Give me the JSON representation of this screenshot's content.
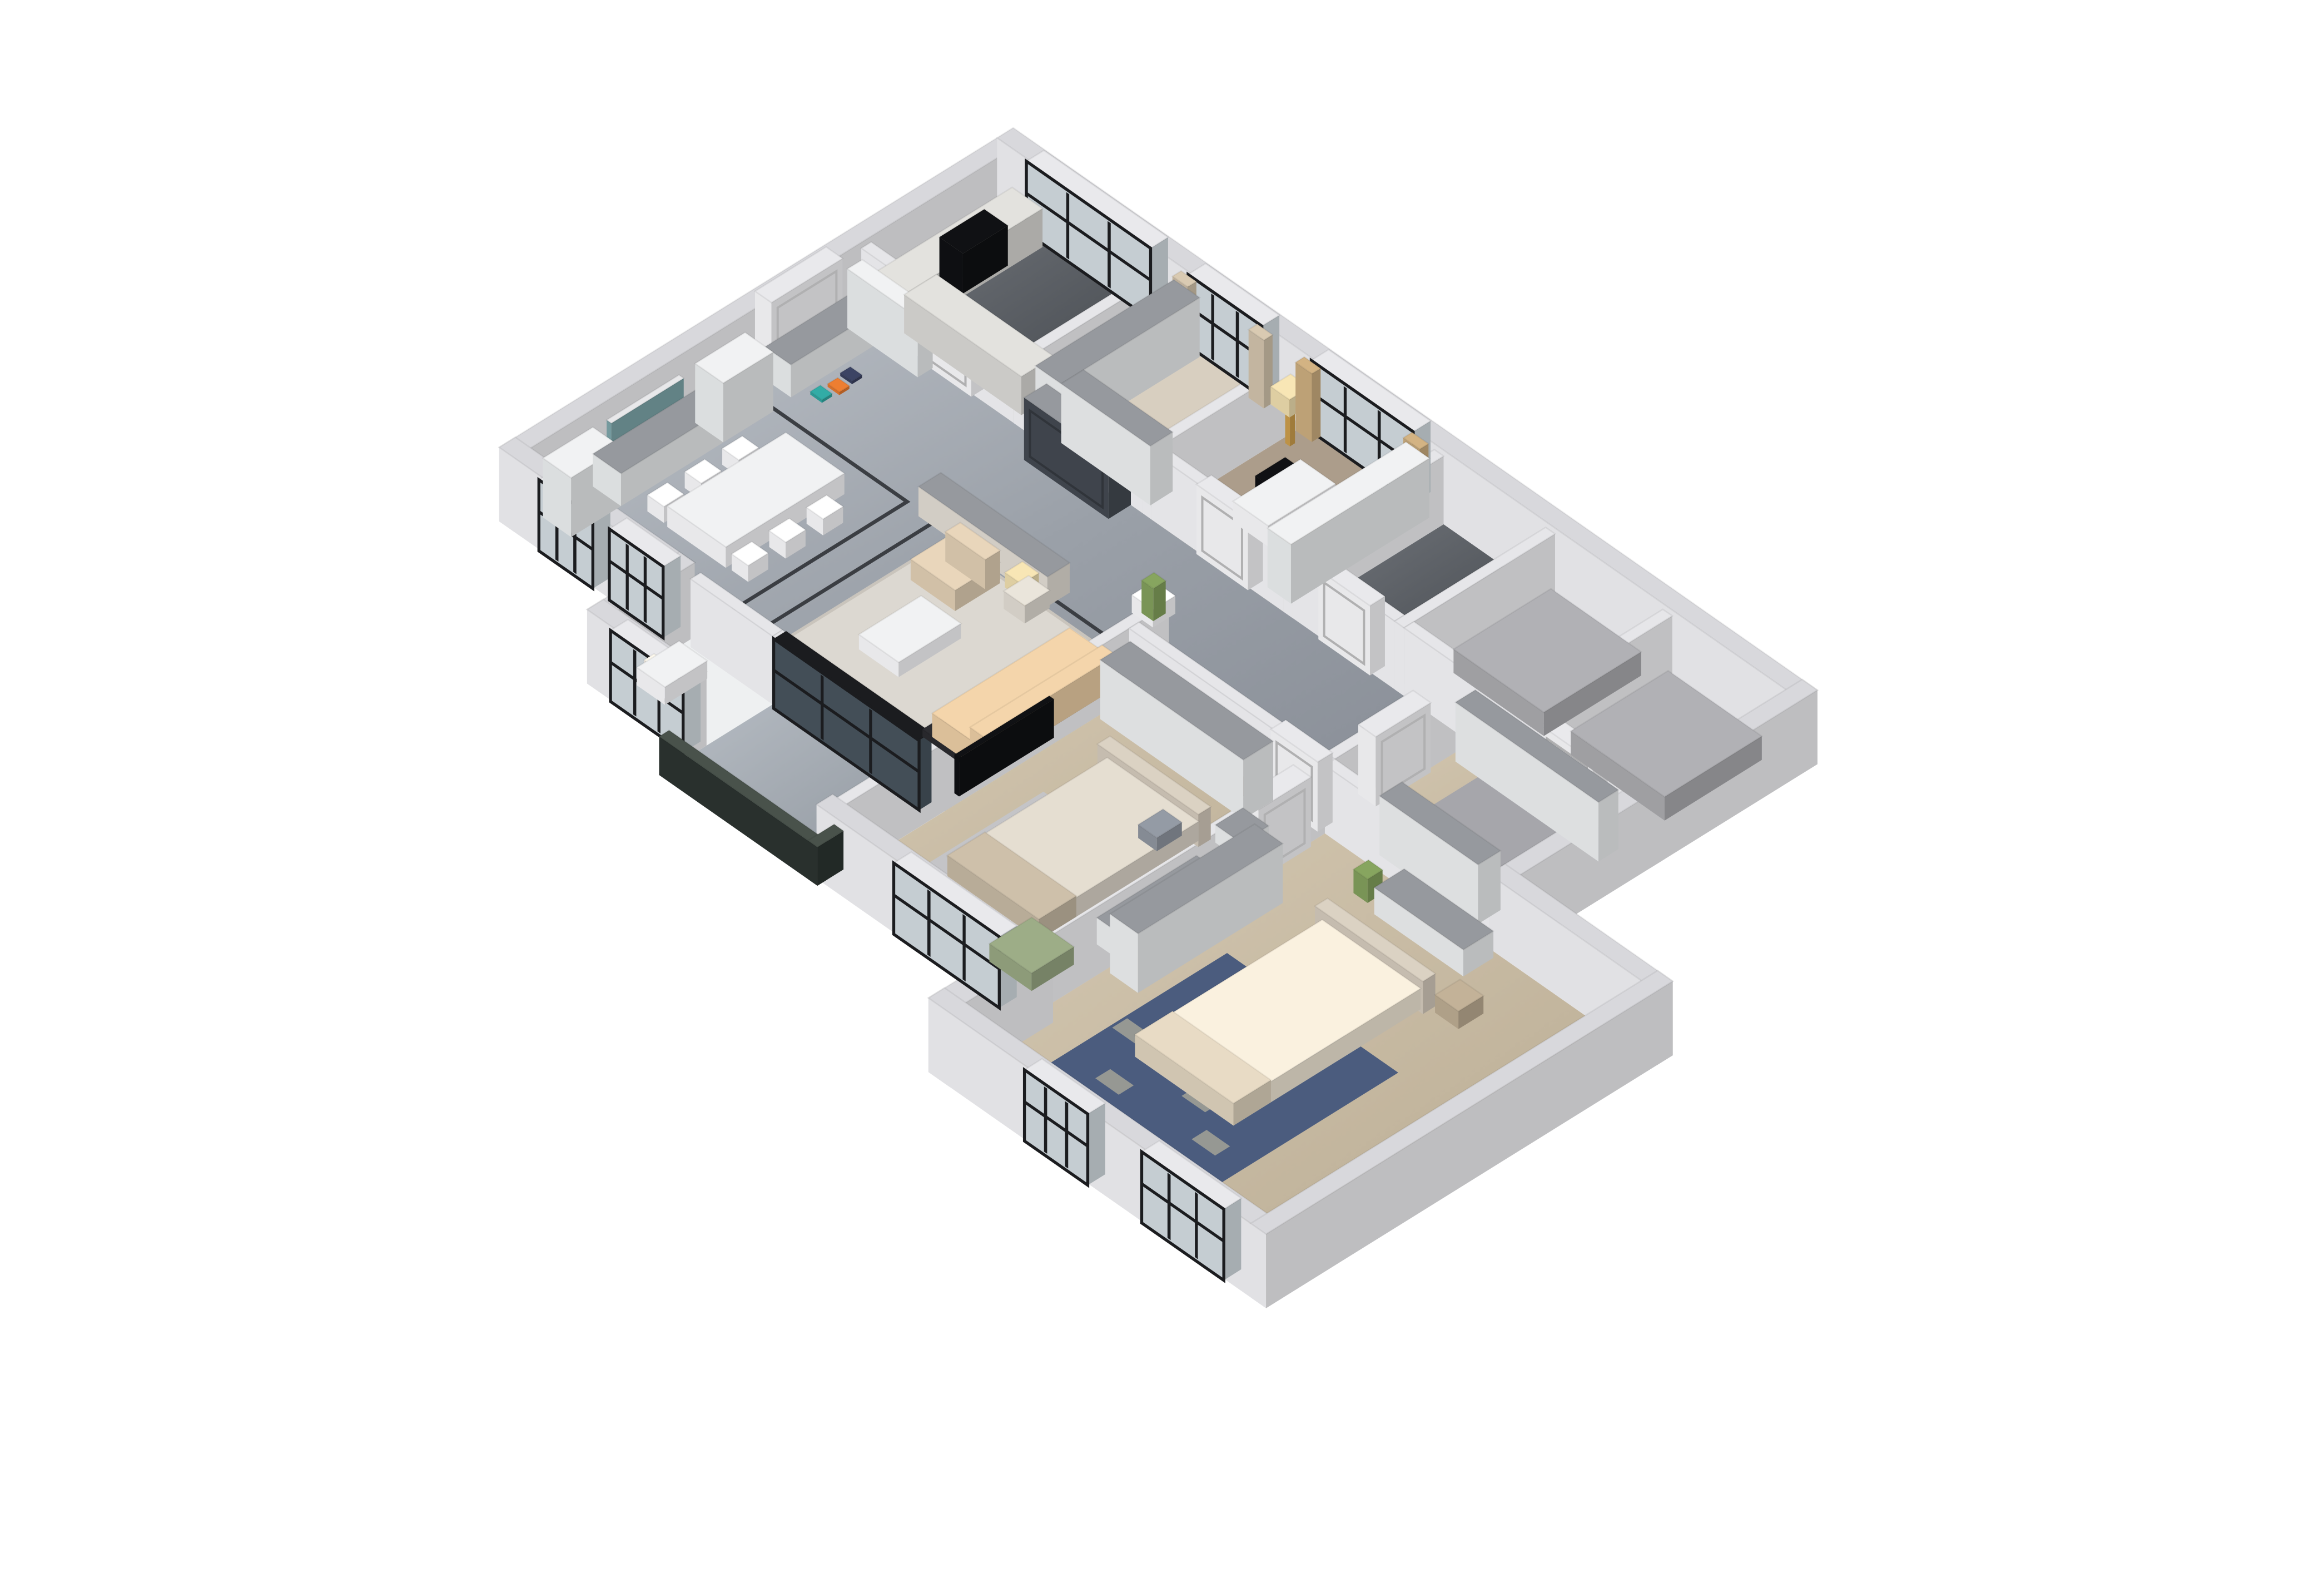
{
  "scene": {
    "title": "3D isometric dollhouse render of a three-bedroom apartment floor plan",
    "background": "#ffffff"
  },
  "palette": {
    "wallExt": "#ededf0",
    "wallExtCap": "#d8d8dc",
    "wallInt": "#f0f0f3",
    "wallIntCap": "#e6e6e9",
    "marbleInlay": "#3b3e43",
    "woodPale": "#d8cfc0",
    "studyCarpet": "#ac9d8b",
    "grayFloor": "#b8b8bb",
    "grayBlock": "#a7a7ab",
    "bayFloor": "#eef0f1",
    "glass": "#cfd8dd",
    "frameBlack": "#1b1c1f",
    "sliderGlass": "#46525c",
    "railing": "#2b332f",
    "railCap": "#49524b",
    "doorWhite": "#f4f4f6",
    "doorCap": "#e9e9ec",
    "hutch": "#e7eaeb",
    "cabinetWhite": "#e9ebec",
    "cabinetCap": "#f1f2f3",
    "greyCap": "#96999e",
    "counter": "#d6d5d1",
    "counterCap": "#e3e2de",
    "sideboard": "#ddd8cf",
    "fridge": "#424850",
    "tv": "#0f1013",
    "sofa": "#e6c9a1",
    "sofaTrim": "#2a2a2e",
    "pillowLight": "#f3ede2",
    "pillowGray": "#8c929c",
    "armchair": "#dccab0",
    "bedGreige": "#d8d1c5",
    "bedRunner": "#c2b5a0",
    "bedCream": "#ece3d2",
    "bedFold": "#dbcfba",
    "headboard": "#cfc6b8",
    "rugLiving": "#dcd8d1",
    "rugLivingEdge": "#c9c4bc",
    "rugBlue": "#4b5c7e",
    "rugBluePattern": "#d6cba4",
    "rugGray": "#c4c4c7",
    "rugCorridor": "#a6a6ab",
    "green": "#94a37f",
    "curtainGold": "#c7a97c",
    "curtainBeige": "#cdbfa8",
    "lampGold": "#c79a4a",
    "lampShade": "#ead9ab",
    "artTeal": "#7ba2a6",
    "artFrame": "#e8e8ea",
    "flowerPurple": "#7b5fa3",
    "flowerYellow": "#c3cc55",
    "plantGreen": "#7f9c5a",
    "stool": "#b8a88f",
    "shoesTeal": "#2fa29d",
    "shoesOrange": "#e0772e",
    "shoesNavy": "#39405e"
  },
  "rooms": [
    {
      "id": "dining",
      "name": "Dining room"
    },
    {
      "id": "entry",
      "name": "Entry hall"
    },
    {
      "id": "kitchen",
      "name": "Kitchen"
    },
    {
      "id": "closet",
      "name": "Walk-in closet"
    },
    {
      "id": "study",
      "name": "Study"
    },
    {
      "id": "bath",
      "name": "Bathroom"
    },
    {
      "id": "storageA",
      "name": "Unfurnished room A"
    },
    {
      "id": "storageB",
      "name": "Unfurnished room B"
    },
    {
      "id": "living",
      "name": "Living room"
    },
    {
      "id": "bay",
      "name": "Bay window nook"
    },
    {
      "id": "balcony",
      "name": "Balcony"
    },
    {
      "id": "bedroom2",
      "name": "Second bedroom"
    },
    {
      "id": "corridor",
      "name": "Bedroom corridor"
    },
    {
      "id": "master",
      "name": "Master bedroom"
    }
  ],
  "labels": {
    "hutch-left": "China hutch with wine lattice",
    "hutch-right": "China hutch with wine lattice",
    "sideboard-dining": "Dining sideboard",
    "wall-art": "Landscape painting",
    "dining-table": "Dining table",
    "dining-chair": "Dining chair",
    "table-flowers": "Purple flower centerpiece",
    "shoe-cabinet": "Shoe cabinet",
    "bookshelf-entry": "Open bookshelf",
    "shoes": "High-heel shoes",
    "fridge": "Glass-door refrigerator cabinet",
    "counter": "Kitchen counter",
    "cooktop": "Black cooktop",
    "wardrobe": "Wardrobe",
    "bookcase-study": "Study bookcase",
    "desk": "Writing desk",
    "monitor": "Computer monitor",
    "desk-chair": "Desk chair",
    "floor-lamp": "Gold floor lamp",
    "lamp-shade": "Lamp shade",
    "curtain": "Curtain panel",
    "gray-block": "Unfinished gray volume",
    "sideboard-hall": "Hallway sideboard",
    "sofa": "Tufted beige sofa with black trim",
    "sofa-pillow": "Sofa pillow",
    "coffee-table": "Coffee table",
    "armchair": "Leather armchair",
    "side-table": "Side table",
    "table-lamp": "Table lamp",
    "rug": "Area rug",
    "chaise-bay": "White chaise",
    "railing": "Dark glass balcony railing",
    "balcony-slider": "Black-framed sliding glass door",
    "window": "Black-framed window",
    "door": "White panel door",
    "entry-door": "White entry double door",
    "tv": "Wall-mounted TV",
    "bed": "Bed",
    "headboard": "Headboard",
    "pillow": "Pillow",
    "bed-runner": "Folded throw blanket",
    "green-chaise": "Green lounge chaise",
    "dresser": "Dresser",
    "nightstand": "Nightstand",
    "stool": "Round leather stool",
    "plant": "Potted plant",
    "floor-inlay": "Black marble inlay border",
    "rug-pattern": "Rug leaf pattern"
  }
}
